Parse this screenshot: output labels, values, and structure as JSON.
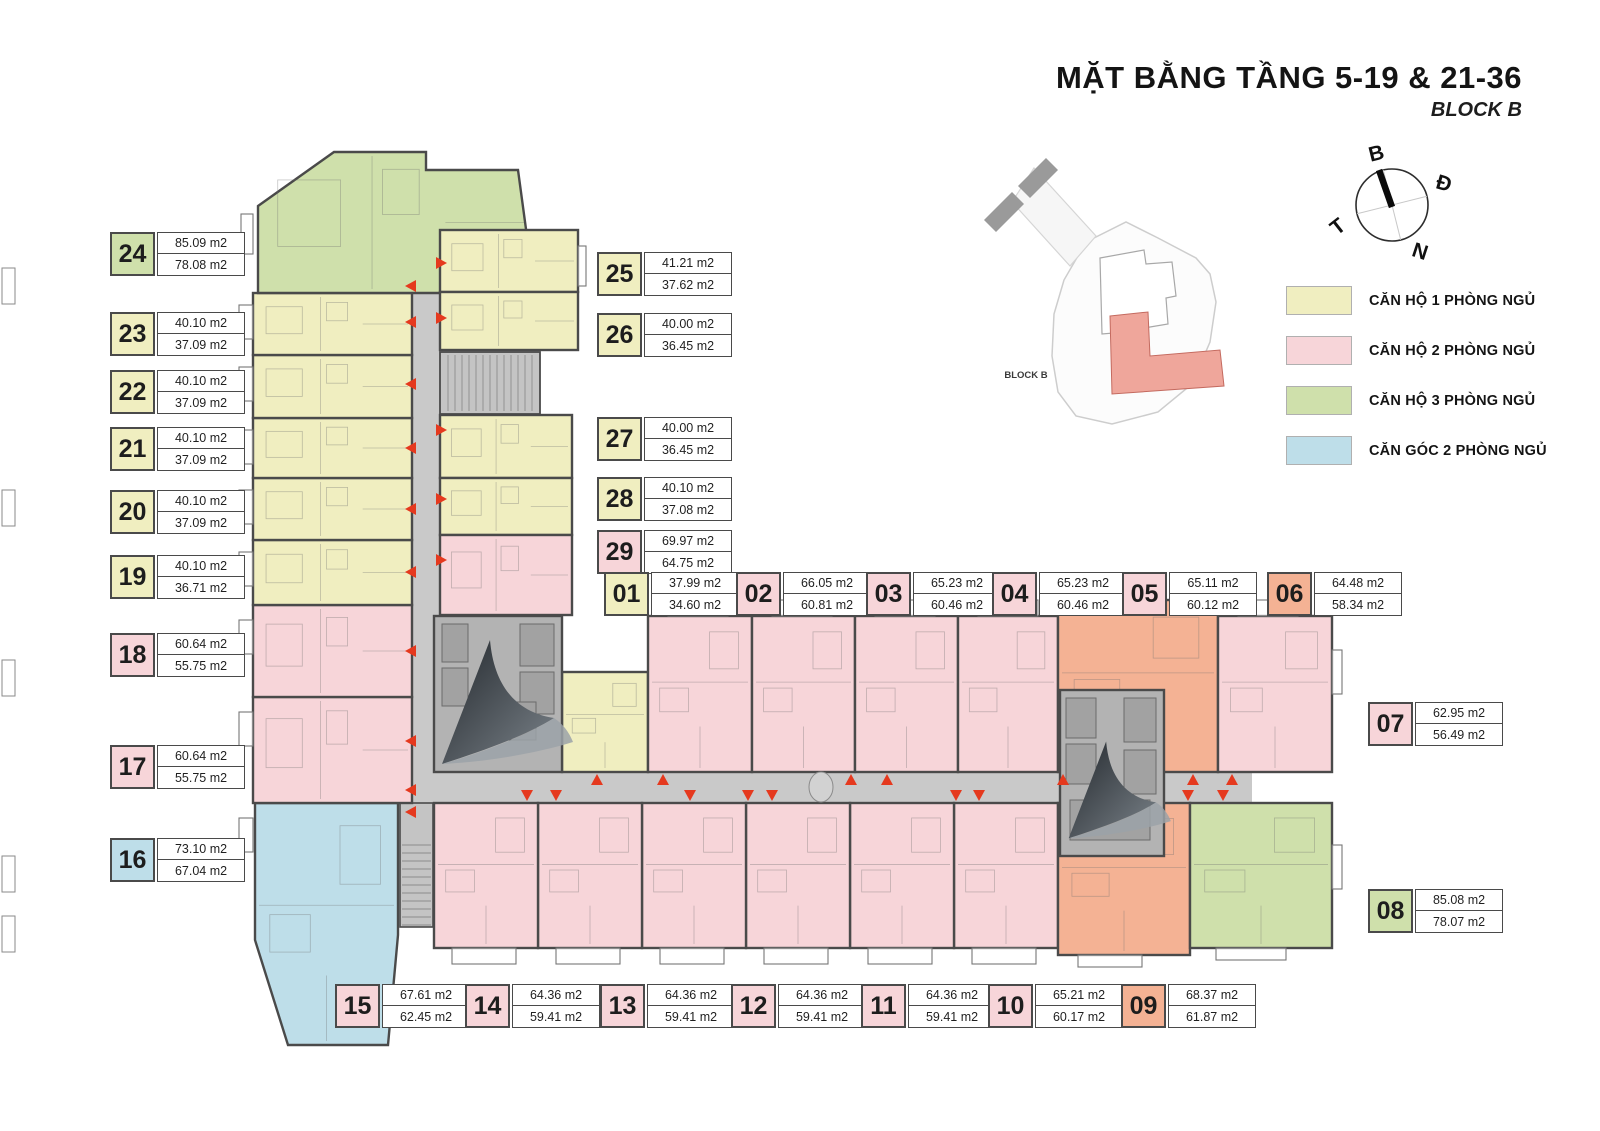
{
  "title": "MẶT BẰNG TẦNG 5-19 & 21-36",
  "subtitle": "BLOCK B",
  "compass": {
    "north": "B",
    "east": "Đ",
    "west": "T",
    "south": "N"
  },
  "legend": {
    "items": [
      {
        "label": "CĂN HỘ 1 PHÒNG NGỦ",
        "color": "yellow"
      },
      {
        "label": "CĂN HỘ 2 PHÒNG NGỦ",
        "color": "pink"
      },
      {
        "label": "CĂN HỘ 3 PHÒNG NGỦ",
        "color": "green"
      },
      {
        "label": "CĂN GÓC 2 PHÒNG NGỦ",
        "color": "blue"
      }
    ]
  },
  "site_map": {
    "block_label": "BLOCK B"
  },
  "colors": {
    "yellow": "#f0eec0",
    "pink": "#f7d5d9",
    "green": "#cfe0ab",
    "blue": "#bedee9",
    "orange": "#f4b294",
    "corridor": "#c9c9c9",
    "core": "#b3b3b3",
    "stair": "#c4c4c4",
    "wall": "#4a4a4a",
    "arrow": "#e5391e",
    "site_block_b": "#efa69b"
  },
  "units": [
    {
      "id": "01",
      "color": "yellow",
      "area1": "37.99 m2",
      "area2": "34.60 m2"
    },
    {
      "id": "02",
      "color": "pink",
      "area1": "66.05 m2",
      "area2": "60.81 m2"
    },
    {
      "id": "03",
      "color": "pink",
      "area1": "65.23 m2",
      "area2": "60.46 m2"
    },
    {
      "id": "04",
      "color": "pink",
      "area1": "65.23 m2",
      "area2": "60.46 m2"
    },
    {
      "id": "05",
      "color": "pink",
      "area1": "65.11 m2",
      "area2": "60.12 m2"
    },
    {
      "id": "06",
      "color": "orange",
      "area1": "64.48 m2",
      "area2": "58.34 m2"
    },
    {
      "id": "07",
      "color": "pink",
      "area1": "62.95 m2",
      "area2": "56.49 m2"
    },
    {
      "id": "08",
      "color": "green",
      "area1": "85.08 m2",
      "area2": "78.07 m2"
    },
    {
      "id": "09",
      "color": "orange",
      "area1": "68.37 m2",
      "area2": "61.87 m2"
    },
    {
      "id": "10",
      "color": "pink",
      "area1": "65.21 m2",
      "area2": "60.17 m2"
    },
    {
      "id": "11",
      "color": "pink",
      "area1": "64.36 m2",
      "area2": "59.41 m2"
    },
    {
      "id": "12",
      "color": "pink",
      "area1": "64.36 m2",
      "area2": "59.41 m2"
    },
    {
      "id": "13",
      "color": "pink",
      "area1": "64.36 m2",
      "area2": "59.41 m2"
    },
    {
      "id": "14",
      "color": "pink",
      "area1": "64.36 m2",
      "area2": "59.41 m2"
    },
    {
      "id": "15",
      "color": "pink",
      "area1": "67.61 m2",
      "area2": "62.45 m2"
    },
    {
      "id": "16",
      "color": "blue",
      "area1": "73.10 m2",
      "area2": "67.04 m2"
    },
    {
      "id": "17",
      "color": "pink",
      "area1": "60.64 m2",
      "area2": "55.75 m2"
    },
    {
      "id": "18",
      "color": "pink",
      "area1": "60.64 m2",
      "area2": "55.75 m2"
    },
    {
      "id": "19",
      "color": "yellow",
      "area1": "40.10 m2",
      "area2": "36.71 m2"
    },
    {
      "id": "20",
      "color": "yellow",
      "area1": "40.10 m2",
      "area2": "37.09 m2"
    },
    {
      "id": "21",
      "color": "yellow",
      "area1": "40.10 m2",
      "area2": "37.09 m2"
    },
    {
      "id": "22",
      "color": "yellow",
      "area1": "40.10 m2",
      "area2": "37.09 m2"
    },
    {
      "id": "23",
      "color": "yellow",
      "area1": "40.10 m2",
      "area2": "37.09 m2"
    },
    {
      "id": "24",
      "color": "green",
      "area1": "85.09 m2",
      "area2": "78.08 m2"
    },
    {
      "id": "25",
      "color": "yellow",
      "area1": "41.21 m2",
      "area2": "37.62 m2"
    },
    {
      "id": "26",
      "color": "yellow",
      "area1": "40.00 m2",
      "area2": "36.45 m2"
    },
    {
      "id": "27",
      "color": "yellow",
      "area1": "40.00 m2",
      "area2": "36.45 m2"
    },
    {
      "id": "28",
      "color": "yellow",
      "area1": "40.10 m2",
      "area2": "37.08 m2"
    },
    {
      "id": "29",
      "color": "pink",
      "area1": "69.97 m2",
      "area2": "64.75 m2"
    }
  ]
}
